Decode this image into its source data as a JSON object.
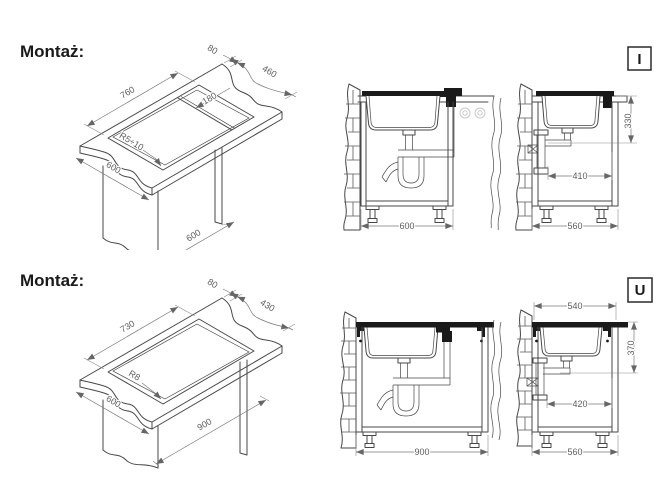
{
  "rows": [
    {
      "label": "Montaż:",
      "marker": "I",
      "iso": {
        "cutout_length": "760",
        "front_gap": "80",
        "cutout_width": "460",
        "drainer_width": "180",
        "corner_radius": "R5÷10",
        "worktop_depth": "600",
        "base_width": "600"
      },
      "front": {
        "base_width": "600"
      },
      "side": {
        "mount_height": "330",
        "drain_offset": "410",
        "base_depth": "560"
      }
    },
    {
      "label": "Montaż:",
      "marker": "U",
      "iso": {
        "cutout_length": "730",
        "front_gap": "80",
        "cutout_width": "430",
        "corner_radius": "R8",
        "worktop_depth": "600",
        "base_width": "900"
      },
      "front": {
        "base_width": "900"
      },
      "side": {
        "top_width": "540",
        "mount_height": "370",
        "drain_offset": "420",
        "base_depth": "560"
      }
    }
  ],
  "colors": {
    "line": "#474747",
    "dim": "#777777",
    "ink": "#1a1a1a",
    "faint": "#c9c9c9"
  }
}
